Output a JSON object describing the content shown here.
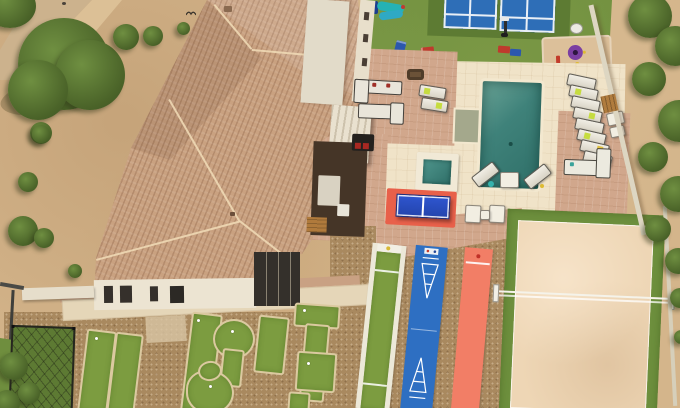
{
  "scene": {
    "type": "aerial-photo",
    "description": "Aerial drone view of a desert estate with tile-roof house, resort backyard: pool, spa, pickleball courts, playground, ping pong, shuffleboard, bocce, sand volleyball court and mini golf",
    "house": {
      "label": "main-house",
      "roof_color": "#c9a180",
      "flat_roof_color": "#e2dbc9",
      "wall_color": "#ece4d2",
      "window_color": "#34302b"
    },
    "front_yard": {
      "label": "desert-landscaping",
      "dirt_color": "#d4b58b",
      "road_color": "#ccb28d",
      "tree_color": "#4b6429"
    },
    "lawn": {
      "label": "artificial-turf-lawn",
      "color": "#6f8e3e"
    },
    "pickleball": {
      "label": "pickleball-courts",
      "court_count": 2,
      "court_color": "#2e6eb7",
      "surround_color": "#5d7b33",
      "line_color": "#ffffff"
    },
    "playground": {
      "label": "play-structure",
      "slide_color": "#25b2b4",
      "tower_color": "#1c3e8e",
      "cornhole_board_count": 4,
      "sand_color": "#dcc09a",
      "toy_umbrella_color": "#7b3fa2"
    },
    "pool_area": {
      "label": "swimming-pool",
      "water_color": "#3f827a",
      "deck_color": "#f0e3c8",
      "paver_color": "#d1a78c",
      "spa_water_color": "#3f857c",
      "poolside_lounger_count": 8,
      "foot_lounger_count": 2,
      "armchair_count": 2,
      "sectional_count": 3,
      "towel_color": "#c6dc3f"
    },
    "ping_pong": {
      "label": "ping-pong-table",
      "table_color": "#2b50c8",
      "mat_color": "#e8604a"
    },
    "game_courts": {
      "bocce": {
        "label": "bocce-court",
        "turf_color": "#7c9c40",
        "frame_color": "#ece8d8"
      },
      "shuffleboard": {
        "label": "shuffleboard-court",
        "surface_color": "#2e6fc2",
        "marking_color": "#ffffff"
      },
      "red_court": {
        "label": "red-game-court",
        "surface_color": "#f27e66"
      }
    },
    "volleyball": {
      "label": "sand-volleyball-court",
      "sand_color": "#eed6b5",
      "border_color": "#6d8f3d",
      "net_color": "#f5f3ea"
    },
    "mini_golf": {
      "label": "putting-course",
      "green_count": 10,
      "turf_color": "#7c9c40",
      "base_color": "#a9895f",
      "golf_ball_count": 6
    },
    "batting_cage": {
      "label": "net-cage",
      "net_color": "#26261f",
      "turf_color": "#5d7a33"
    },
    "hardscape": {
      "aggregate_color": "#a9895f",
      "walkway_color": "#e5d6b8",
      "wall_color": "#ddd6c2",
      "gate_color": "#b07c3e"
    },
    "equipment": {
      "basketball_hoop": 1,
      "fire_pit_color": "#6b5238",
      "grill_color": "#24211e",
      "birds_flying": 2
    }
  }
}
